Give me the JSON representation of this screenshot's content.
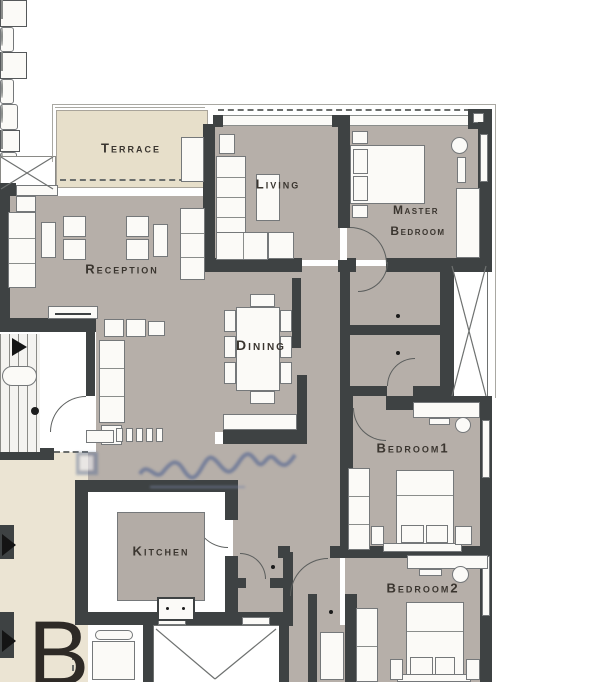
{
  "unit_label": "B",
  "rooms": {
    "terrace": "Terrace",
    "living": "Living",
    "master_line1": "Master",
    "master_line2": "Bedroom",
    "reception": "Reception",
    "dining": "Dining",
    "bedroom1": "Bedroom1",
    "kitchen": "Kitchen",
    "bedroom2": "Bedroom2"
  },
  "colors": {
    "wall": "#3e4243",
    "floor": "#b6afa9",
    "terrace_floor": "#e7dfca",
    "lobby_floor": "#ebe4d3",
    "furniture": "#fbfaf7",
    "label_text": "#3a352f",
    "watermark": "#5a6d96"
  },
  "icons": {
    "stairs_direction": "arrow-right-icon",
    "elevator": "elevator-v-icon",
    "shaft": "x-cross-icon",
    "entry_doors": "black-triangle-icon"
  }
}
